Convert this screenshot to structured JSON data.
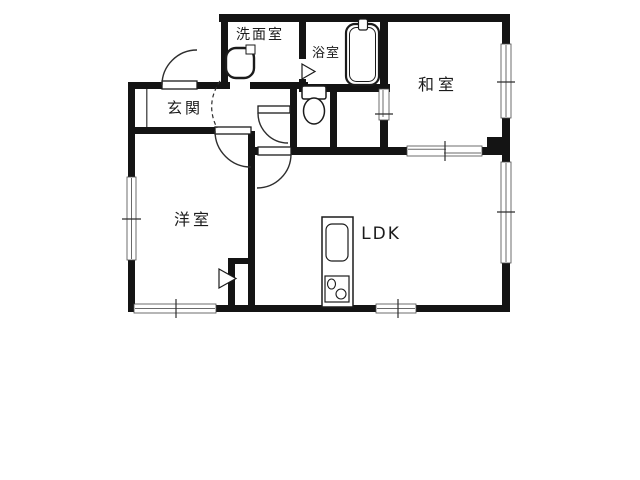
{
  "floorplan": {
    "title": "apartment-floor-plan",
    "rooms": [
      {
        "id": "washroom",
        "label": "洗面室"
      },
      {
        "id": "bathroom",
        "label": "浴室"
      },
      {
        "id": "japanese-room",
        "label": "和室"
      },
      {
        "id": "entrance",
        "label": "玄関"
      },
      {
        "id": "western-room",
        "label": "洋室"
      },
      {
        "id": "ldk",
        "label": "LDK"
      }
    ],
    "symbols": {
      "door_swing": "quarter-arc",
      "sliding_door": "offset-double-line",
      "window": "white-slot-with-tick",
      "fold_door": "triangle"
    },
    "colors": {
      "background": "#ffffff",
      "wall": "#141414",
      "line": "#2e2e2e"
    }
  }
}
